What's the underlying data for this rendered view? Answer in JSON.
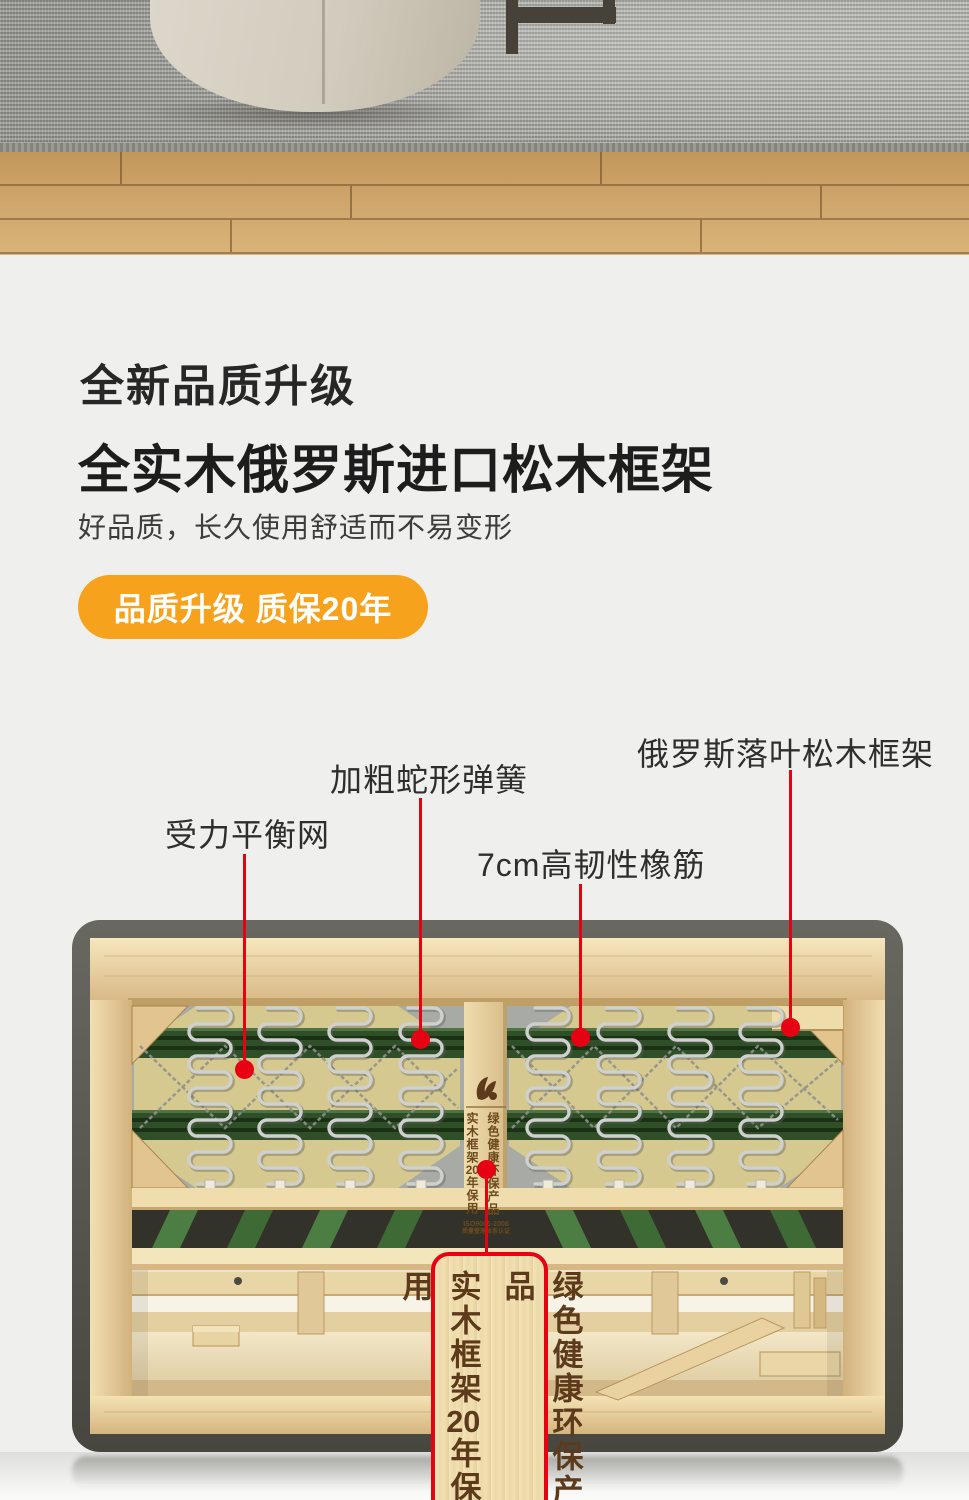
{
  "headline": {
    "eyebrow": "全新品质升级",
    "title": "全实木俄罗斯进口松木框架",
    "subtitle": "好品质，长久使用舒适而不易变形",
    "pill": "品质升级 质保20年"
  },
  "callouts": {
    "labels": [
      "受力平衡网",
      "加粗蛇形弹簧",
      "7cm高韧性橡筋",
      "俄罗斯落叶松木框架"
    ]
  },
  "frame": {
    "beam": {
      "left": {
        "prefix": "实木框架",
        "num": "20",
        "suffix": "年保用"
      },
      "right": "绿色健康环保产品",
      "cert1": "ISO9001-2008",
      "cert2": "质量管理体系认证"
    },
    "plaque": {
      "left": {
        "prefix": "实木框架",
        "num": "20",
        "suffix": "年保用"
      },
      "right": "绿色健康环保产品"
    }
  },
  "colors": {
    "accent_orange": "#f7a21d",
    "callout_red": "#e60213",
    "page_bg": "#efefee"
  }
}
